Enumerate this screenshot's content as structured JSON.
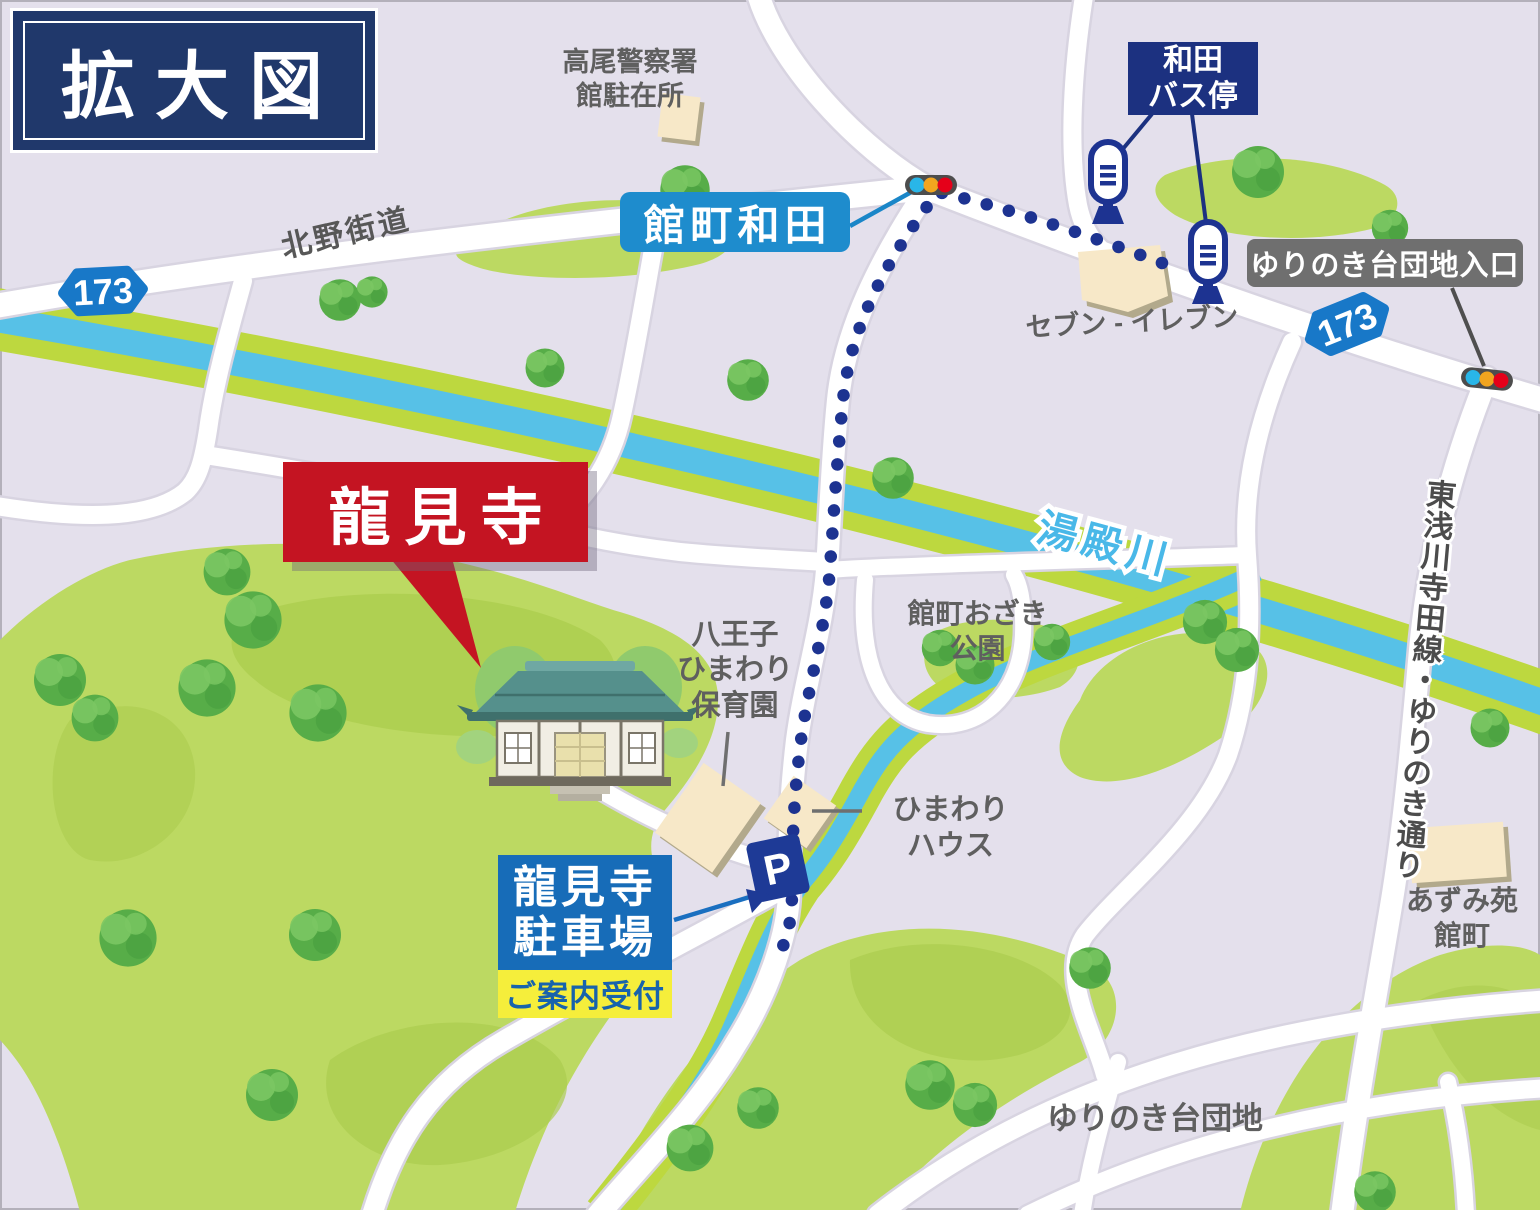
{
  "title": "拡大図",
  "labels": {
    "police_line1": "高尾警察署",
    "police_line2": "館駐在所",
    "wada_bus_line1": "和田",
    "wada_bus_line2": "バス停",
    "tatemachi_wada": "館町和田",
    "yurinoki_entrance": "ゆりのき台団地入口",
    "seven_eleven": "セブン - イレブン",
    "kitano_kaido": "北野街道",
    "route_number": "173",
    "yudono_river": "湯殿川",
    "ryukenji": "龍見寺",
    "nursery_line1": "八王子",
    "nursery_line2": "ひまわり",
    "nursery_line3": "保育園",
    "ozaki_line1": "館町おざき",
    "ozaki_line2": "公園",
    "himawari_line1": "ひまわり",
    "himawari_line2": "ハウス",
    "parking_line1": "龍見寺",
    "parking_line2": "駐車場",
    "reception": "ご案内受付",
    "parking_symbol": "P",
    "azumi_line1": "あずみ苑",
    "azumi_line2": "館町",
    "yurinoki_danchi": "ゆりのき台団地",
    "vertical_road": "東浅川寺田線・ゆりのき通り"
  },
  "colors": {
    "background": "#e4e0ec",
    "road": "#ffffff",
    "green_area": "#bcd962",
    "green_patch": "#abcc4e",
    "river": "#57c1e7",
    "river_bank": "#bdd83f",
    "route_dots_navy": "#1d3391",
    "title_navy": "#20386b",
    "bus_box_navy": "#1c3180",
    "label_blue": "#1e8ccd",
    "parking_blue": "#176cb8",
    "shield_blue": "#1878c8",
    "temple_red": "#c41422",
    "reception_yellow": "#f5ee3b",
    "gray_box": "#6f6f6f",
    "label_gray": "#5f5f5f",
    "river_label_blue": "#49b8e8",
    "signal_cyan": "#29b6e8",
    "signal_orange": "#f2a51f",
    "signal_red": "#e50019"
  }
}
